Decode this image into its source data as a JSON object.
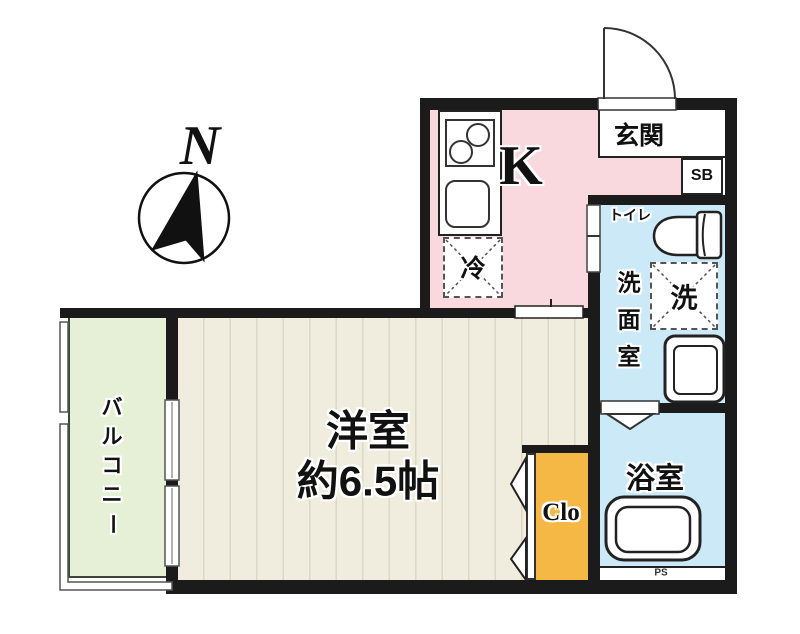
{
  "colors": {
    "wall": "#1b1b1b",
    "kitchen_pink": "#f9d8de",
    "water_blue": "#cbe9f7",
    "room_beige": "#f1edde",
    "room_stripe": "#dcd8c6",
    "balcony_green": "#e5f0d7",
    "closet_orange": "#f6b845",
    "line_dark": "#222222"
  },
  "compass": {
    "north_label": "N"
  },
  "rooms": {
    "entrance": {
      "label": "玄関"
    },
    "shoe_box": {
      "label": "SB"
    },
    "kitchen": {
      "label": "K"
    },
    "refrigerator": {
      "label": "冷"
    },
    "toilet": {
      "label": "トイレ"
    },
    "washing_machine": {
      "label": "洗"
    },
    "washroom": {
      "chars": [
        "洗",
        "面",
        "室"
      ]
    },
    "bathroom": {
      "label": "浴室"
    },
    "pipe_space": {
      "label": "PS"
    },
    "main_room": {
      "label": "洋室",
      "size": "約6.5帖"
    },
    "closet": {
      "label": "Clo"
    },
    "balcony": {
      "chars": [
        "バ",
        "ル",
        "コ",
        "ニ",
        "ー"
      ]
    }
  }
}
